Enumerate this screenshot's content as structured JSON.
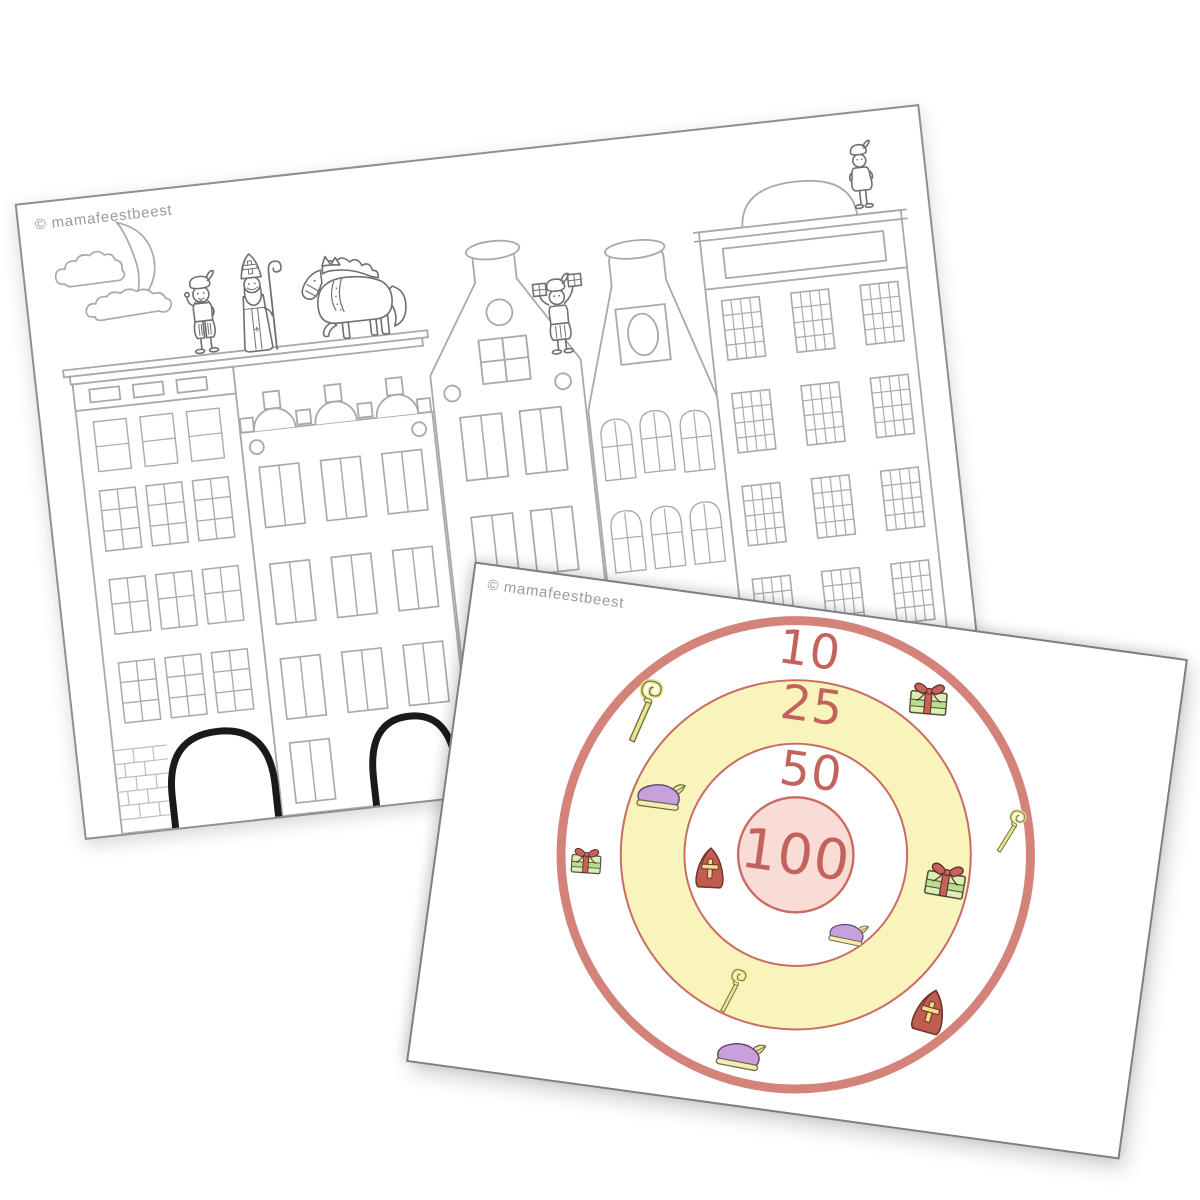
{
  "back_page": {
    "watermark": "© mamafeestbeest",
    "scene": {
      "sky_icons": [
        "crescent-moon-icon",
        "cloud-icon",
        "cloud-icon"
      ],
      "rooftop_figures": [
        "piet-waving",
        "sinterklaas-with-staff",
        "horse-amerigo",
        "piet-holding-presents",
        "piet-on-right-house"
      ],
      "houses": [
        "flat-cornice-house",
        "crenellated-gable-house",
        "pointed-gable-house",
        "funnel-gable-house",
        "arched-pediment-house"
      ],
      "bridge_arches_count": 2
    }
  },
  "front_page": {
    "watermark": "© mamafeestbeest",
    "target": {
      "rings": [
        {
          "label": "10",
          "points": 10,
          "fill": "#ffffff"
        },
        {
          "label": "25",
          "points": 25,
          "fill": "#f8f4bb"
        },
        {
          "label": "50",
          "points": 50,
          "fill": "#ffffff"
        },
        {
          "label": "100",
          "points": 100,
          "fill": "#f9dcd6"
        }
      ],
      "icons": [
        {
          "name": "staff-icon",
          "ring": "10",
          "position": "upper-left"
        },
        {
          "name": "gift-icon",
          "ring": "10",
          "position": "upper-right"
        },
        {
          "name": "piet-beret-icon",
          "ring": "25",
          "position": "left"
        },
        {
          "name": "staff-icon",
          "ring": "10",
          "position": "right"
        },
        {
          "name": "gift-icon",
          "ring": "10",
          "position": "left"
        },
        {
          "name": "mijter-icon",
          "ring": "50",
          "position": "left"
        },
        {
          "name": "gift-icon",
          "ring": "25",
          "position": "right"
        },
        {
          "name": "piet-beret-icon",
          "ring": "50",
          "position": "lower-right"
        },
        {
          "name": "staff-icon",
          "ring": "25",
          "position": "lower-left"
        },
        {
          "name": "mijter-icon",
          "ring": "10",
          "position": "lower-right"
        },
        {
          "name": "piet-beret-icon",
          "ring": "10",
          "position": "bottom"
        }
      ]
    }
  },
  "colors": {
    "page_background": "#ffffff",
    "back_page_border": "#8f8f8f",
    "front_page_border": "#7e7e7e",
    "target_outer_border": "#d4837b",
    "target_ring_line": "#c96c64",
    "target_label_text": "#c4635d",
    "ring_yellow": "#f8f4bb",
    "ring_pink": "#f9dcd6",
    "watermark_gray": "#9b9b9b",
    "line_art_gray": "#a9a9a9",
    "figure_line_gray": "#6f6f6f",
    "arch_black": "#1a1a1a",
    "gift_green": "#d9efb3",
    "gift_band_green": "#b9dd8e",
    "gift_ribbon_red": "#c4635d",
    "beret_purple": "#c7a0dc",
    "beret_brim_yellow": "#f3ecb4",
    "mijter_red": "#c05c50",
    "mijter_cross_yellow": "#efdc8d",
    "staff_yellow": "#e9e393"
  }
}
